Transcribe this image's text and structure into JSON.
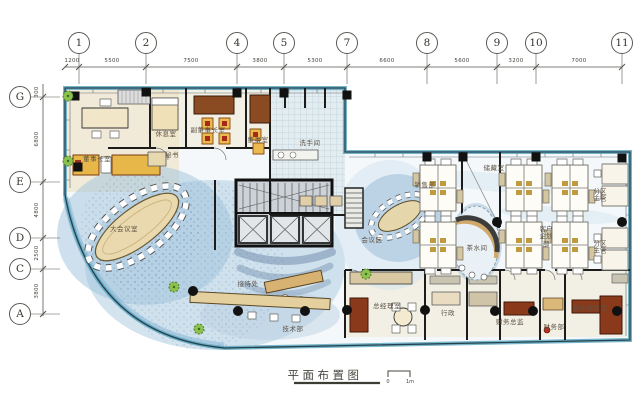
{
  "title": {
    "label": "平面布置图",
    "scale_start": "0",
    "scale_end": "1m"
  },
  "grid": {
    "top_axes": [
      {
        "label": "1"
      },
      {
        "label": "2"
      },
      {
        "label": "4"
      },
      {
        "label": "5"
      },
      {
        "label": "7"
      },
      {
        "label": "8"
      },
      {
        "label": "9"
      },
      {
        "label": "10"
      },
      {
        "label": "11"
      }
    ],
    "top_dims": [
      "1200",
      "5500",
      "7500",
      "3800",
      "5300",
      "6600",
      "5600",
      "3200",
      "7000"
    ],
    "left_axes": [
      {
        "label": "G"
      },
      {
        "label": "E"
      },
      {
        "label": "D"
      },
      {
        "label": "C"
      },
      {
        "label": "A"
      }
    ],
    "left_dims": [
      "300",
      "6800",
      "4800",
      "2500",
      "3800"
    ]
  },
  "rooms": [
    {
      "id": "chairman-office",
      "label": "董事长室"
    },
    {
      "id": "lounge",
      "label": "休息室"
    },
    {
      "id": "vice-chairman-office",
      "label": "副董事长室"
    },
    {
      "id": "directors-room",
      "label": "董事室"
    },
    {
      "id": "secretary",
      "label": "秘书"
    },
    {
      "id": "washroom",
      "label": "洗手间"
    },
    {
      "id": "main-conference-room",
      "label": "大会议室"
    },
    {
      "id": "reception",
      "label": "接待处"
    },
    {
      "id": "technical-dept",
      "label": "技术部"
    },
    {
      "id": "general-manager-office",
      "label": "总经理室"
    },
    {
      "id": "admin",
      "label": "行政"
    },
    {
      "id": "finance-director",
      "label": "财务总监"
    },
    {
      "id": "finance-dept",
      "label": "财务部"
    },
    {
      "id": "deputy-gm-office",
      "label": "副总经理室"
    },
    {
      "id": "sales-dept",
      "label": "销售部"
    },
    {
      "id": "storage-room",
      "label": "储藏室"
    },
    {
      "id": "meeting-area",
      "label": "会议区"
    },
    {
      "id": "tea-room",
      "label": "茶水间"
    },
    {
      "id": "client-planning-dept",
      "label": "客户企划部"
    },
    {
      "id": "zone-supervisor-1",
      "label": "分区主管"
    },
    {
      "id": "zone-supervisor-2",
      "label": "分区主管"
    }
  ],
  "colors": {
    "glass_teal": "#5fa8bf",
    "wash_blue": "#a9cade",
    "beige": "#eedfbc",
    "wood_dark": "#8a3a1a",
    "sofa_orange": "#e8b74a",
    "line": "#1c1c1c"
  }
}
